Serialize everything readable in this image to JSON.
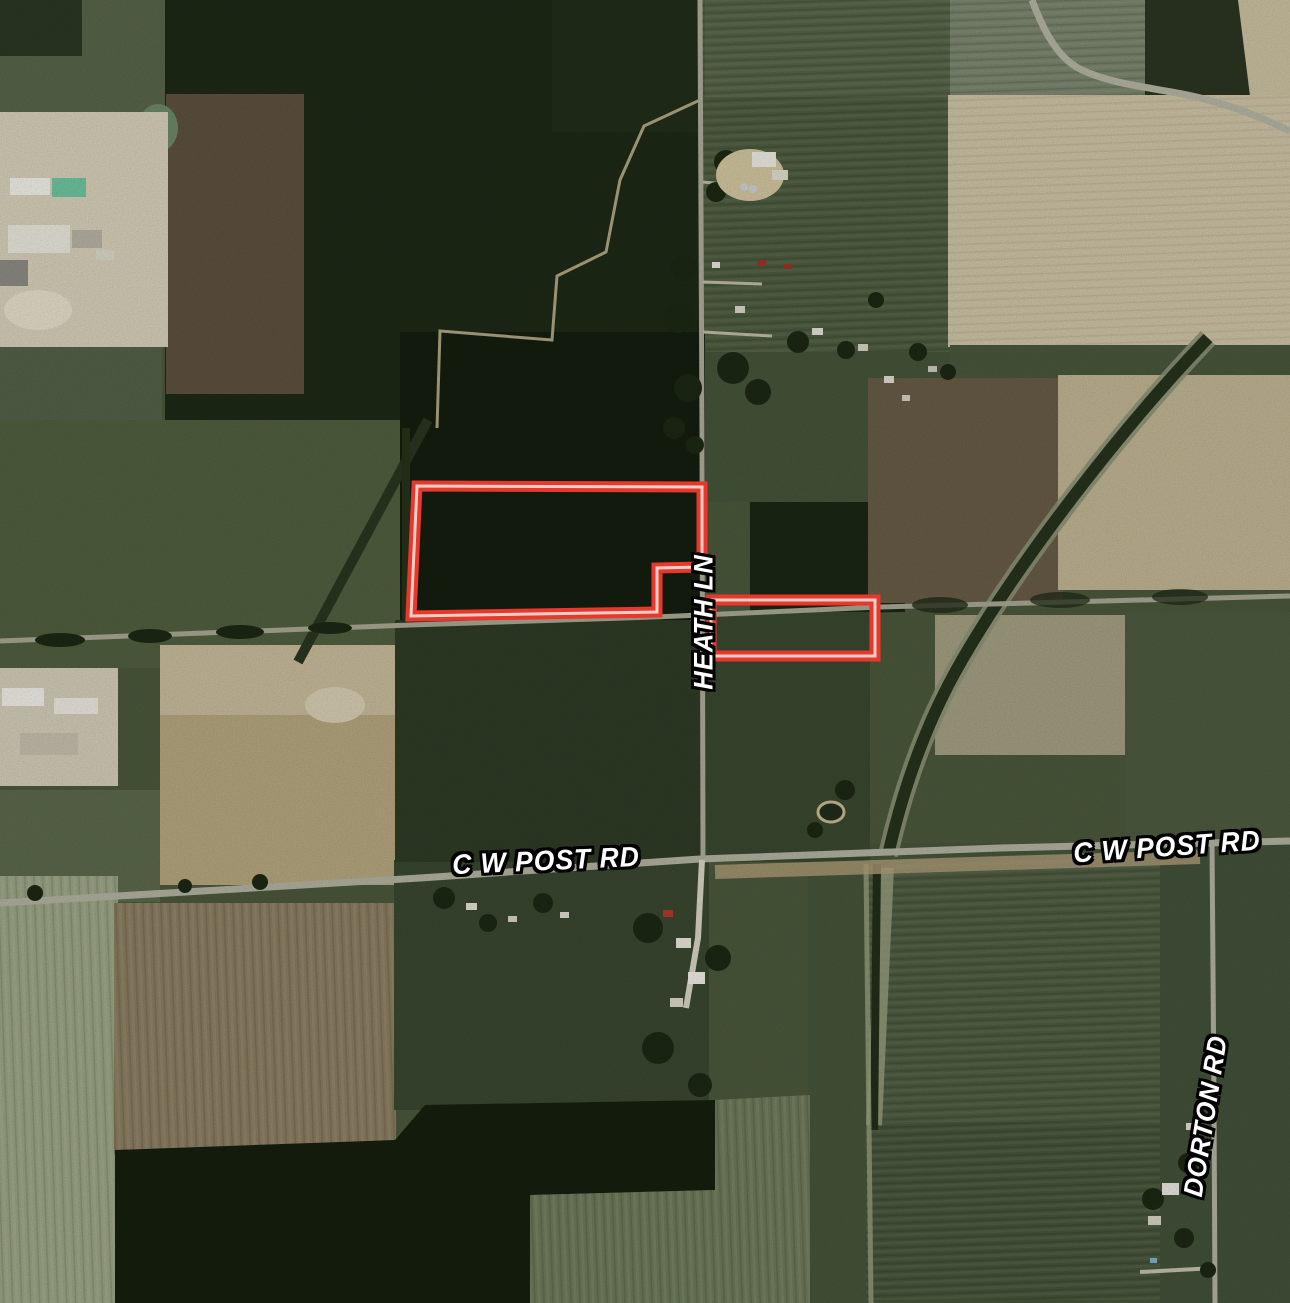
{
  "map": {
    "description": "Aerial satellite view of farmland with two highlighted parcel boundaries",
    "colors": {
      "parcel_outline": "#e8372c",
      "parcel_inner_line": "#f8cfc6",
      "label_text": "#ffffff",
      "label_outline": "#000000"
    },
    "road_labels": [
      {
        "id": "heath-ln",
        "text": "HEATH LN",
        "orientation": "vertical"
      },
      {
        "id": "cw-post-rd-west",
        "text": "C W POST RD",
        "orientation": "horizontal"
      },
      {
        "id": "cw-post-rd-east",
        "text": "C W POST RD",
        "orientation": "horizontal"
      },
      {
        "id": "dorton-rd",
        "text": "DORTON RD",
        "orientation": "vertical"
      }
    ],
    "parcels": [
      {
        "id": "parcel-large",
        "points": "417,486 702,487 702,567 657,568 657,612 411,616"
      },
      {
        "id": "parcel-small",
        "points": "711,600 875,600 875,656 711,656"
      }
    ]
  }
}
